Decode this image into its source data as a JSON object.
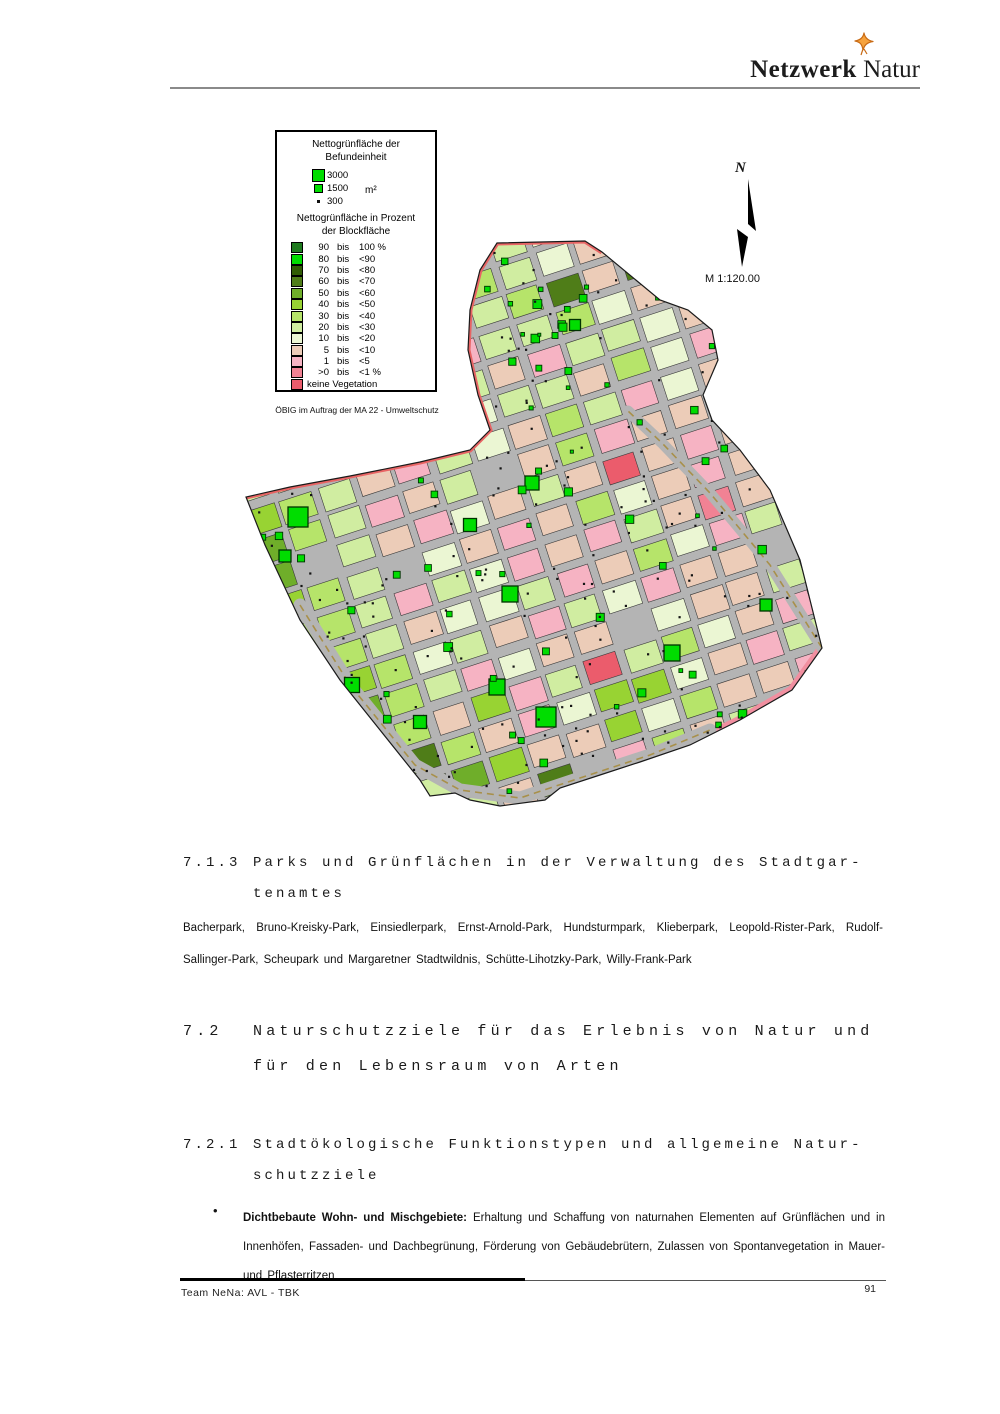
{
  "header": {
    "logo_bold": "Netzwerk",
    "logo_regular": " Natur"
  },
  "map": {
    "legend": {
      "title1": "Nettogrünfläche der",
      "title2": "Befundeinheit",
      "sizes": [
        {
          "label": "3000",
          "size": 11
        },
        {
          "label": "1500",
          "size": 7
        },
        {
          "label": "300",
          "size": 3
        }
      ],
      "unit": "m²",
      "subtitle1": "Nettogrünfläche in Prozent",
      "subtitle2": "der Blockfläche",
      "bis_label": "bis",
      "classes": [
        {
          "from": "90",
          "to": "100 %",
          "color": "#1f7a1f"
        },
        {
          "from": "80",
          "to": "<90",
          "color": "#00dd00"
        },
        {
          "from": "70",
          "to": "<80",
          "color": "#305c04"
        },
        {
          "from": "60",
          "to": "<70",
          "color": "#4f7d18"
        },
        {
          "from": "50",
          "to": "<60",
          "color": "#6fae2a"
        },
        {
          "from": "40",
          "to": "<50",
          "color": "#98d333"
        },
        {
          "from": "30",
          "to": "<40",
          "color": "#b6e46a"
        },
        {
          "from": "20",
          "to": "<30",
          "color": "#d0eda1"
        },
        {
          "from": "10",
          "to": "<20",
          "color": "#ebf6d3"
        },
        {
          "from": "5",
          "to": "<10",
          "color": "#ecccb8"
        },
        {
          "from": "1",
          "to": "<5",
          "color": "#f6b3c3"
        },
        {
          "from": ">0",
          "to": "<1 %",
          "color": "#f18294"
        },
        {
          "label": "keine Vegetation",
          "color": "#eb5c6c"
        }
      ]
    },
    "credit": "ÖBIG im Auftrag der MA 22 - Umweltschutz",
    "north_label": "N",
    "scale_label": "M 1:120.00",
    "base_color": "#b4b4b4",
    "colors": {
      "boundary_red": "#e86464",
      "boundary_pink": "#f18fa0",
      "road_gray": "#b4b4b4",
      "rail_tan": "#a8904a",
      "symbol_green": "#00dd00",
      "symbol_border": "#003300",
      "dot": "#141414",
      "block_border": "#3a3a3a",
      "outline": "#1a1a1a"
    },
    "outline": [
      [
        267,
        18
      ],
      [
        355,
        16
      ],
      [
        372,
        27
      ],
      [
        430,
        75
      ],
      [
        458,
        85
      ],
      [
        482,
        105
      ],
      [
        488,
        135
      ],
      [
        473,
        170
      ],
      [
        482,
        195
      ],
      [
        510,
        225
      ],
      [
        540,
        265
      ],
      [
        570,
        335
      ],
      [
        592,
        423
      ],
      [
        562,
        465
      ],
      [
        510,
        495
      ],
      [
        460,
        520
      ],
      [
        410,
        537
      ],
      [
        370,
        550
      ],
      [
        330,
        563
      ],
      [
        315,
        575
      ],
      [
        270,
        581
      ],
      [
        240,
        575
      ],
      [
        225,
        568
      ],
      [
        200,
        571
      ],
      [
        190,
        555
      ],
      [
        150,
        505
      ],
      [
        110,
        455
      ],
      [
        70,
        395
      ],
      [
        35,
        320
      ],
      [
        16,
        272
      ],
      [
        60,
        262
      ],
      [
        120,
        251
      ],
      [
        190,
        237
      ],
      [
        240,
        225
      ],
      [
        260,
        205
      ],
      [
        248,
        170
      ],
      [
        238,
        125
      ],
      [
        240,
        85
      ],
      [
        250,
        45
      ]
    ],
    "red_stripe": [
      [
        372,
        27
      ],
      [
        355,
        16
      ],
      [
        267,
        18
      ],
      [
        250,
        45
      ],
      [
        240,
        85
      ],
      [
        238,
        125
      ],
      [
        248,
        170
      ],
      [
        260,
        205
      ],
      [
        240,
        225
      ],
      [
        190,
        237
      ],
      [
        120,
        251
      ],
      [
        60,
        262
      ],
      [
        16,
        272
      ]
    ],
    "pink_stripe": [
      [
        592,
        423
      ],
      [
        562,
        465
      ],
      [
        510,
        495
      ],
      [
        460,
        520
      ],
      [
        410,
        537
      ],
      [
        370,
        550
      ],
      [
        330,
        563
      ]
    ],
    "roads": [
      {
        "pts": [
          [
            70,
            380
          ],
          [
            120,
            460
          ],
          [
            185,
            540
          ],
          [
            230,
            565
          ],
          [
            290,
            573
          ],
          [
            350,
            553
          ],
          [
            420,
            530
          ],
          [
            480,
            505
          ]
        ],
        "w": 13
      },
      {
        "pts": [
          [
            592,
            423
          ],
          [
            540,
            340
          ],
          [
            480,
            268
          ],
          [
            432,
            218
          ],
          [
            398,
            186
          ]
        ],
        "w": 11
      }
    ],
    "grid": {
      "tx": -40,
      "ty": 270,
      "angle": -18,
      "cw": 40,
      "chh": 31,
      "gap": 7,
      "voff": -250,
      "rows": [
        "77777777777777777777",
        "77777777788777777777",
        "77777777667877777777",
        "7777777a67879a777777",
        "777777796789a9777777",
        "777777a87639397a7777",
        "7777769a77689aa77777",
        "777776879a7789b7a777",
        "67777a9877968a987777",
        "15679a78967a89a97b77",
        "0467a97896a9989ab977",
        "24679a8979c9a96a9a77",
        "3567989a9689a9799677",
        "2667a78a9a79b9a89977",
        "74679887a968a7a99b77",
        "7356879a78a99c699a77",
        "77467a89968997a99677",
        "772695a7c7689a969777",
        "777369a85589a7997777",
        "7777459958699a997777",
        "77777939a69799777777",
        "77777799799777777777",
        "77777777777777777777",
        "77777777777777777777",
        "77777777777777777777"
      ]
    },
    "large_symbols": [
      [
        68,
        292,
        20
      ],
      [
        55,
        331,
        12
      ],
      [
        240,
        300,
        13
      ],
      [
        280,
        369,
        16
      ],
      [
        122,
        460,
        15
      ],
      [
        190,
        497,
        13
      ],
      [
        267,
        462,
        16
      ],
      [
        316,
        492,
        20
      ],
      [
        345,
        100,
        11
      ],
      [
        442,
        428,
        16
      ],
      [
        536,
        380,
        12
      ],
      [
        302,
        258,
        14
      ]
    ],
    "seed": 11,
    "small_symbol_count": 115,
    "dot_count": 270
  },
  "sections": {
    "s713": {
      "num": "7.1.3",
      "line1": "Parks und Grünflächen in der Verwaltung des Stadtgar-",
      "line2": "tenamtes"
    },
    "parks": "Bacherpark, Bruno-Kreisky-Park, Einsiedlerpark, Ernst-Arnold-Park, Hundsturmpark, Klieberpark, Leopold-Rister-Park, Rudolf-Sallinger-Park, Scheupark und Margaretner Stadtwildnis, Schütte-Lihotzky-Park, Willy-Frank-Park",
    "s72": {
      "num": "7.2",
      "line1": "Naturschutzziele für das Erlebnis von Natur und",
      "line2": "für den Lebensraum von Arten"
    },
    "s721": {
      "num": "7.2.1",
      "line1": "Stadtökologische Funktionstypen und allgemeine Natur-",
      "line2": "schutzziele"
    },
    "bullet": {
      "marker": "•",
      "lead": "Dichtbebaute Wohn- und Mischgebiete:",
      "text": " Erhaltung und Schaffung von naturnahen Elementen auf Grünflächen und in Innenhöfen, Fassaden- und Dachbegrünung, Förderung von Gebäudebrütern, Zulassen von Spontanvegetation in Mauer- und Pflasterritzen"
    }
  },
  "footer": {
    "team": "Team NeNa: AVL - TBK",
    "page_number": "91"
  }
}
